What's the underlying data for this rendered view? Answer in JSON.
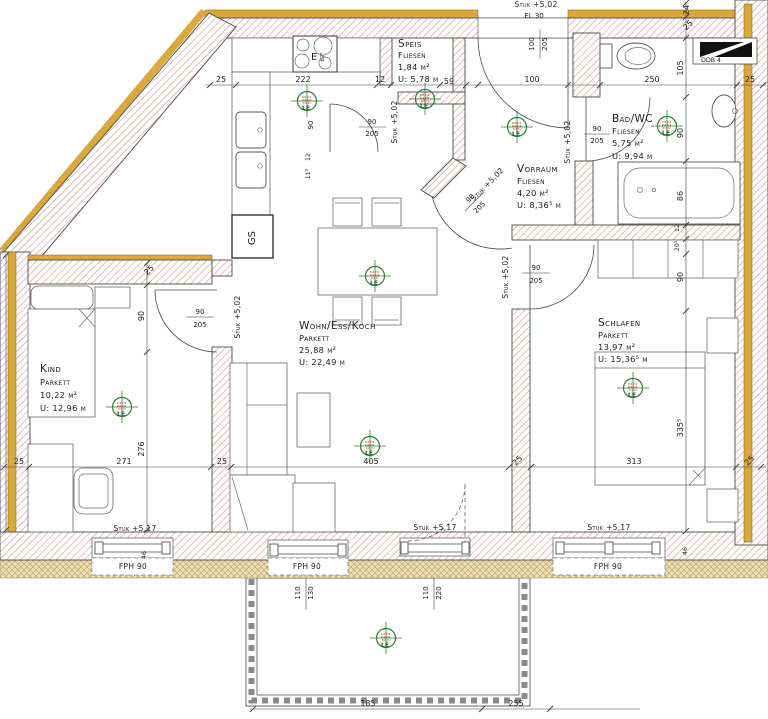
{
  "plan": {
    "rooms": [
      {
        "name": "Speis",
        "floor": "Fliesen",
        "area": "1,84 m²",
        "perim": "U: 5,78 m"
      },
      {
        "name": "Vorraum",
        "floor": "Fliesen",
        "area": "4,20 m²",
        "perim": "U: 8,36⁵ m"
      },
      {
        "name": "Bad/WC",
        "floor": "Fliesen",
        "area": "5,75 m²",
        "perim": "U: 9,94 m"
      },
      {
        "name": "Kind",
        "floor": "Parkett",
        "area": "10,22 m²",
        "perim": "U: 12,96 m"
      },
      {
        "name": "Wohn/Ess/Koch",
        "floor": "Parkett",
        "area": "25,88 m²",
        "perim": "U: 22,49 m"
      },
      {
        "name": "Schlafen",
        "floor": "Parkett",
        "area": "13,97 m²",
        "perim": "U: 15,36⁵ m"
      }
    ],
    "labels": {
      "dishwasher": "GS",
      "stove": "E",
      "duct": "DDB 4",
      "entry_note": "EL 30",
      "marker": "LE"
    },
    "levels": {
      "lintel_502": "Stuk +5,02",
      "lintel_517": "Stuk +5,17",
      "parapet": "FPH 90"
    },
    "door_size": {
      "w": "90",
      "h": "205"
    },
    "entrance_size": {
      "w": "100",
      "h": "205"
    },
    "balcony_openings": [
      {
        "w": "110",
        "h": "130"
      },
      {
        "w": "110",
        "h": "220"
      }
    ],
    "dims": {
      "top": [
        "25",
        "222",
        "12",
        "59",
        "100",
        "250",
        "25"
      ],
      "right": [
        "24",
        "25",
        "105",
        "90",
        "86",
        "12",
        "20⁵",
        "90",
        "335⁵"
      ],
      "left": [
        "25",
        "90",
        "276"
      ],
      "bottom": [
        "25",
        "271",
        "25",
        "405",
        "25",
        "313",
        "25"
      ],
      "balcony": [
        "185",
        "255"
      ],
      "misc": [
        "46",
        "46",
        "90",
        "12",
        "11⁵",
        "62⁵"
      ]
    }
  }
}
